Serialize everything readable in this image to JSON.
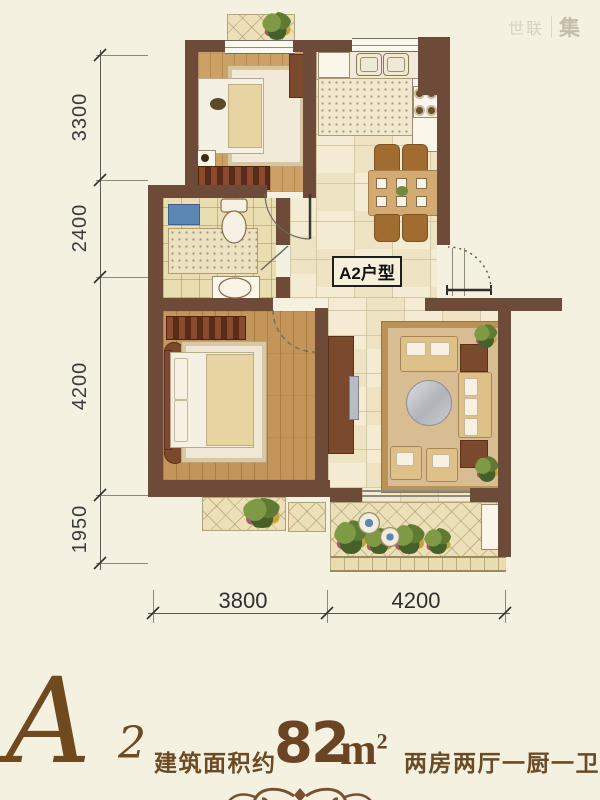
{
  "watermark": {
    "left": "世联",
    "right": "集"
  },
  "plan_label": "A2户型",
  "dims": {
    "left": [
      "3300",
      "2400",
      "4200",
      "1950"
    ],
    "bottom": [
      "3800",
      "4200"
    ]
  },
  "title": {
    "letter": "A",
    "subscript": "2",
    "prefix": "建筑面积约",
    "area": "82",
    "unit": "m",
    "unit_sup": "2",
    "rooms": "两房两厅一厨一卫"
  },
  "colors": {
    "background": "#f5f1e1",
    "wall": "#6e4a38",
    "title_text": "#6b4a24"
  }
}
